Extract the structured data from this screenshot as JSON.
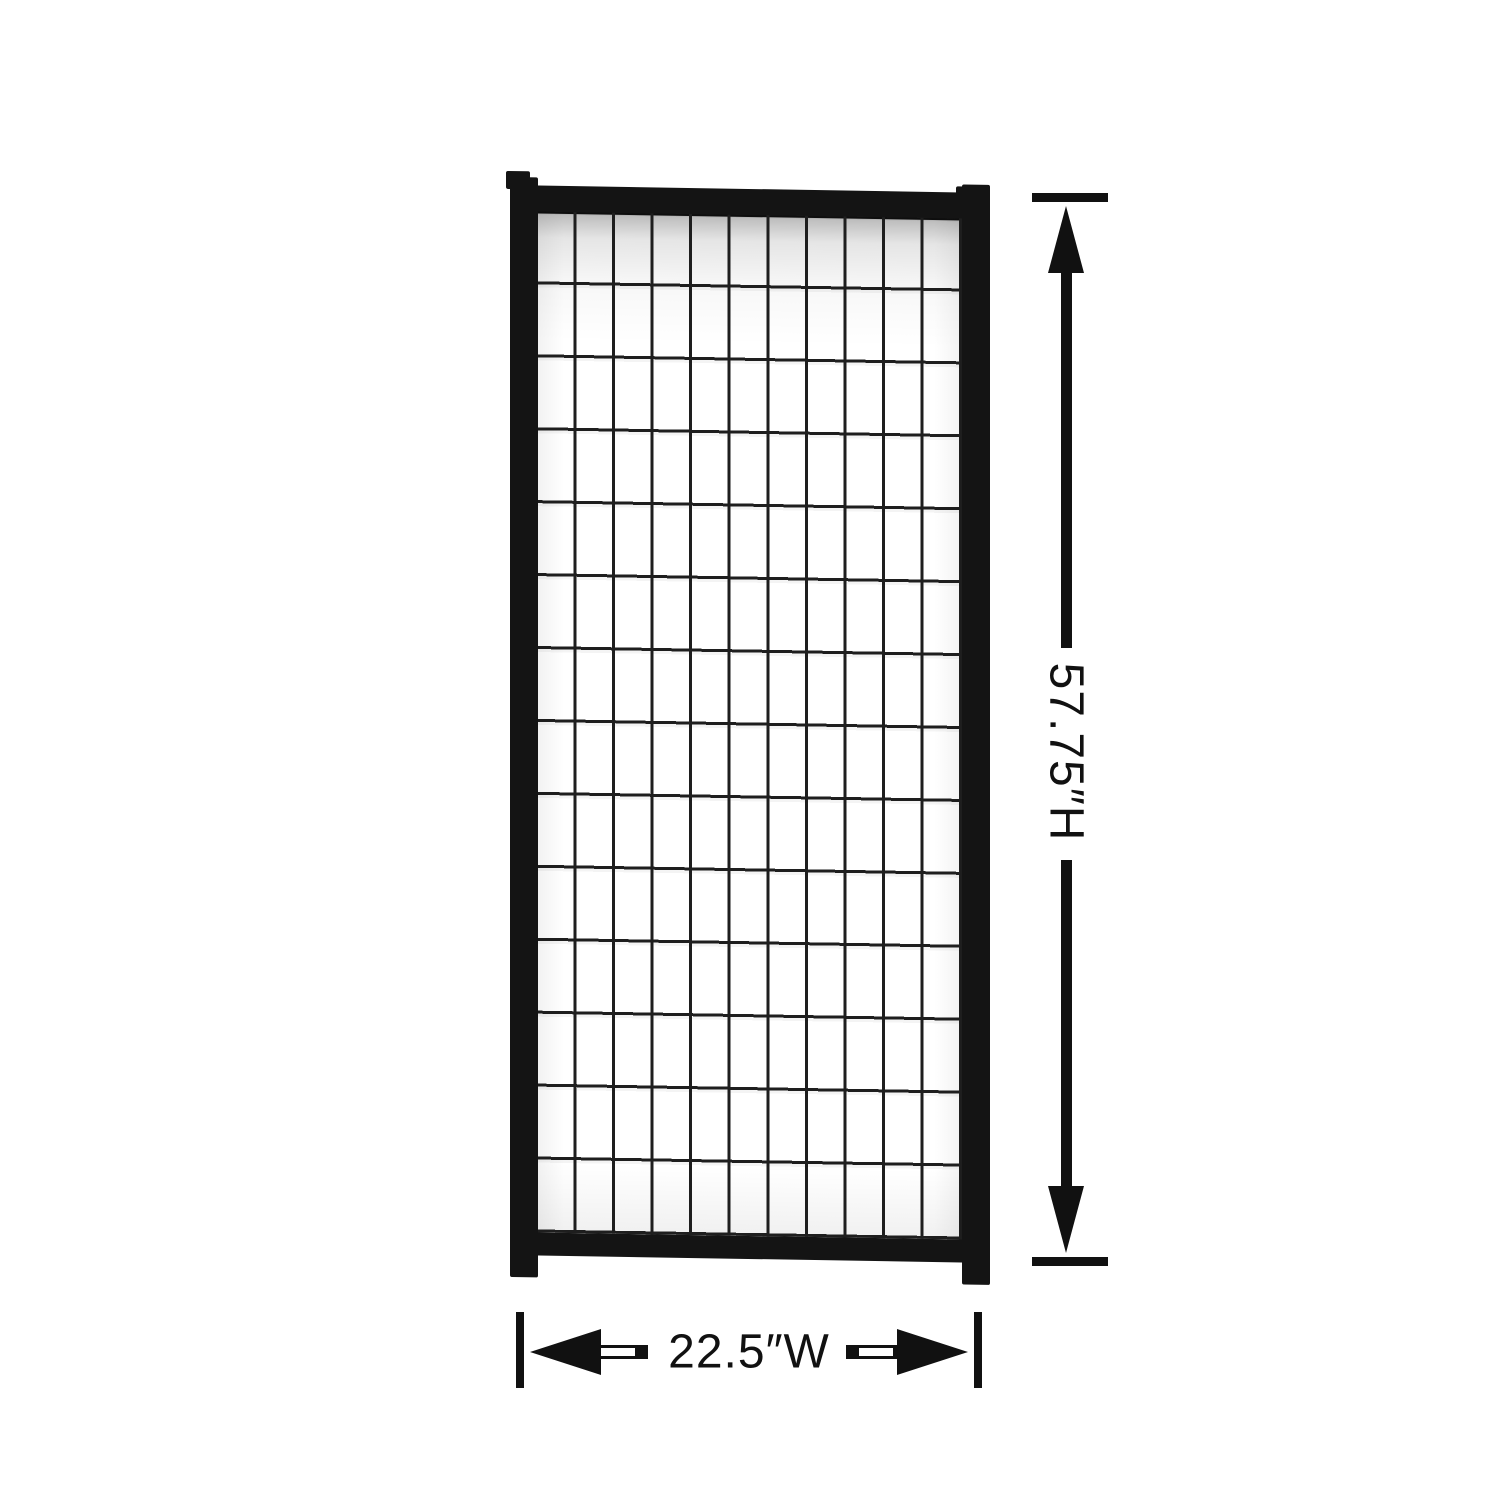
{
  "background_color": "#ffffff",
  "panel": {
    "frame_color": "#141414",
    "mesh": {
      "columns": 11,
      "rows": 14,
      "wire_color": "#1e1e1e",
      "wire_thickness": 3
    }
  },
  "dimensions": {
    "color": "#111111",
    "height": {
      "label": "57.75″H",
      "value": "57.75",
      "axis": "H"
    },
    "width": {
      "label": "22.5″W",
      "value": "22.5",
      "axis": "W"
    }
  }
}
